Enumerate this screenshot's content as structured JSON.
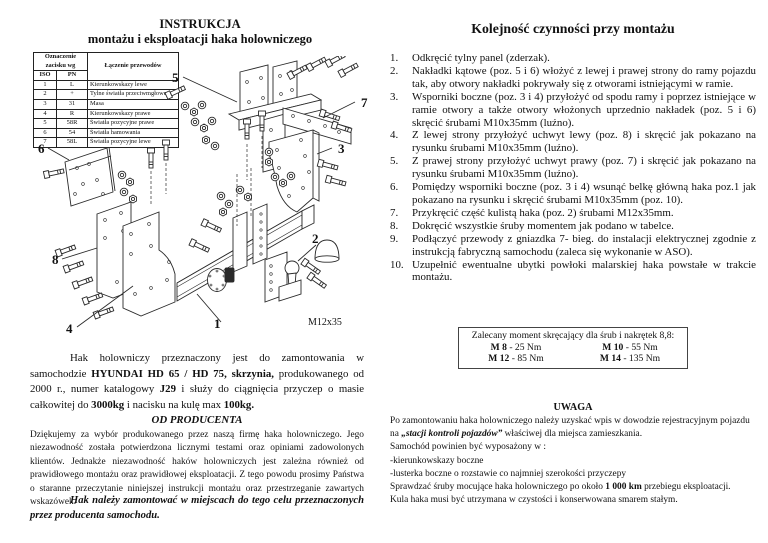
{
  "doc": {
    "left": {
      "title_line1": "INSTRUKCJA",
      "title_line2": "montażu i eksploatacji haka holowniczego",
      "wiring_table": {
        "hdr_mark": "Oznaczenie zacisku wg",
        "hdr_iso": "ISO",
        "hdr_pn": "PN",
        "hdr_conn": "Łączenie przewodów",
        "rows": [
          {
            "iso": "1",
            "pn": "L",
            "conn": "Kierunkowskazy lewe"
          },
          {
            "iso": "2",
            "pn": "+",
            "conn": "Tylne światła przeciwmgłowe"
          },
          {
            "iso": "3",
            "pn": "31",
            "conn": "Masa"
          },
          {
            "iso": "4",
            "pn": "R",
            "conn": "Kierunkowskazy prawe"
          },
          {
            "iso": "5",
            "pn": "58R",
            "conn": "Światła pozycyjne prawe"
          },
          {
            "iso": "6",
            "pn": "54",
            "conn": "Światła hamowania"
          },
          {
            "iso": "7",
            "pn": "58L",
            "conn": "Światła pozycyjne lewe"
          }
        ]
      },
      "diagram": {
        "l1": "1",
        "l2": "2",
        "l3": "3",
        "l4": "4",
        "l5": "5",
        "l6": "6",
        "l7": "7",
        "l8": "8",
        "bolt_label": "M12x35"
      },
      "intro": {
        "t1": "Hak holowniczy przeznaczony jest do zamontowania w samochodzie ",
        "b1": "HYUNDAI HD 65 / HD 75, skrzynia,",
        "t2": " produkowanego od 2000 r., numer katalogowy ",
        "b2": "J29",
        "t3": " i służy do ciągnięcia przyczep o masie całkowitej do ",
        "b3": "3000kg",
        "t4": " i nacisku na kulę max ",
        "b4": "100kg."
      },
      "producer": {
        "title": "OD PRODUCENTA",
        "body": "Dziękujemy za wybór produkowanego przez naszą firmę haka holowniczego. Jego niezawodność została potwierdzona licznymi testami oraz opiniami zadowolonych klientów. Jednakże niezawodność haków holowniczych jest zależna również od prawidłowego montażu oraz prawidłowej eksploatacji. Z tego powodu prosimy Państwa o staranne przeczytanie niniejszej instrukcji montażu oraz przestrzeganie zawartych wskazówek.",
        "note": "Hak należy zamontować w miejscach do tego celu przeznaczonych przez producenta samochodu."
      }
    },
    "right": {
      "title": "Kolejność czynności przy montażu",
      "steps": [
        {
          "num": "1.",
          "text": "Odkręcić tylny panel (zderzak)."
        },
        {
          "num": "2.",
          "text": "Nakładki kątowe (poz. 5 i 6) włożyć z lewej i prawej strony do ramy pojazdu tak, aby otwory nakładki pokrywały się z otworami istniejącymi w ramie."
        },
        {
          "num": "3.",
          "text": "Wsporniki boczne (poz. 3 i 4) przyłożyć od spodu ramy i poprzez istniejące w ramie otwory a także otwory włożonych uprzednio nakładek (poz. 5 i 6) skręcić śrubami M10x35mm (luźno)."
        },
        {
          "num": "4.",
          "text": "Z lewej strony przyłożyć uchwyt lewy (poz. 8) i skręcić jak pokazano na rysunku śrubami M10x35mm (luźno)."
        },
        {
          "num": "5.",
          "text": "Z prawej strony przyłożyć uchwyt prawy (poz. 7) i skręcić jak pokazano na rysunku śrubami M10x35mm (luźno)."
        },
        {
          "num": "6.",
          "text": "Pomiędzy wsporniki boczne (poz. 3 i 4) wsunąć belkę główną haka poz.1 jak pokazano na rysunku i skręcić śrubami M10x35mm (poz. 10)."
        },
        {
          "num": "7.",
          "text": "Przykręcić część kulistą haka (poz. 2) śrubami M12x35mm."
        },
        {
          "num": "8.",
          "text": "Dokręcić wszystkie śruby momentem jak podano w tabelce."
        },
        {
          "num": "9.",
          "text": "Podłączyć przewody z gniazdka 7- bieg. do instalacji elektrycznej zgodnie z instrukcją fabryczną samochodu (zaleca się wykonanie  w ASO)."
        },
        {
          "num": "10.",
          "text": "Uzupełnić ewentualne ubytki powłoki malarskiej haka powstałe w trakcie montażu."
        }
      ],
      "torque_box": {
        "title": "Zalecany moment skręcający dla śrub i nakrętek 8,8:",
        "items": [
          {
            "bolt": "M 8",
            "val": "- 25 Nm"
          },
          {
            "bolt": "M 10",
            "val": "- 55 Nm"
          },
          {
            "bolt": "M 12",
            "val": "- 85 Nm"
          },
          {
            "bolt": "M 14",
            "val": "- 135 Nm"
          }
        ]
      },
      "uwaga": {
        "title": "UWAGA",
        "p1a": "Po  zamontowaniu haka holowniczego należy uzyskać wpis w dowodzie rejestracyjnym pojazdu na ",
        "p1b": "„stacji kontroli pojazdów”",
        "p1c": " właściwej dla miejsca zamieszkania.",
        "p2": "Samochód powinien być wyposażony w :",
        "p3": "-kierunkowskazy boczne",
        "p4": "-lusterka boczne  o rozstawie co najmniej szerokości przyczepy",
        "p5a": "Sprawdzać śruby mocujące haka holowniczego po około ",
        "p5b": "1 000 km",
        "p5c": " przebiegu eksploatacji.",
        "p6": "Kula haka musi być utrzymana w czystości i konserwowana smarem stałym."
      }
    }
  }
}
